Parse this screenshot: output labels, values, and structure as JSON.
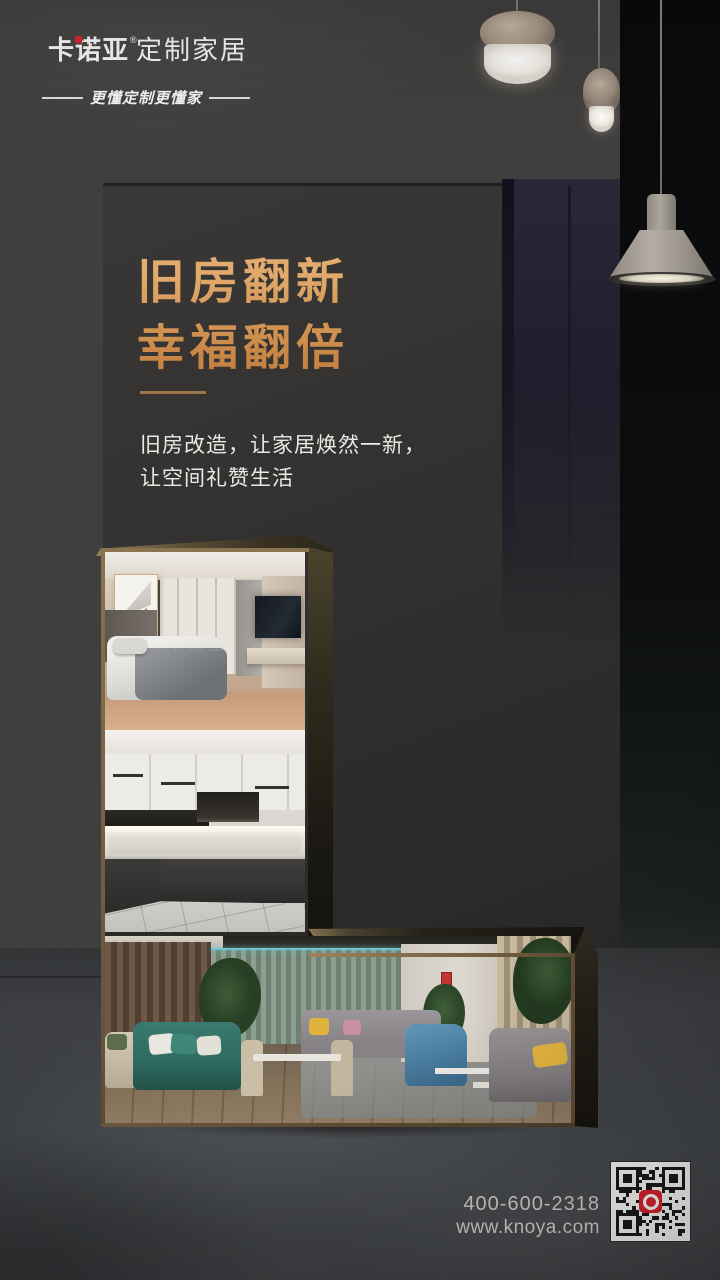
{
  "brand": {
    "logo_main": "卡诺亚",
    "reg_mark": "®",
    "logo_suffix": "定制家居",
    "tagline": "更懂定制更懂家"
  },
  "hero": {
    "headline_line1": "旧房翻新",
    "headline_line2": "幸福翻倍",
    "body_line1": "旧房改造，让家居焕然一新，",
    "body_line2": "让空间礼赞生活"
  },
  "photo_watermark": "卡诺亚",
  "contact": {
    "phone": "400-600-2318",
    "website": "www.knoya.com"
  },
  "colors": {
    "gold1": "#e3ac6e",
    "gold2": "#c5813f",
    "divider": "#a0744a",
    "bodyText": "#ebe9e6",
    "logoText": "#f5f4f2",
    "contactText": "#cccbc9",
    "logoRed": "#d8272e",
    "qrRed": "#d9232e",
    "bg": "#413f3d",
    "panel": "#353331",
    "navy": "#211f2c",
    "rightCol": "#0b0b0c",
    "floor": "#3c3e41",
    "bronze": "#6e5a3e"
  }
}
